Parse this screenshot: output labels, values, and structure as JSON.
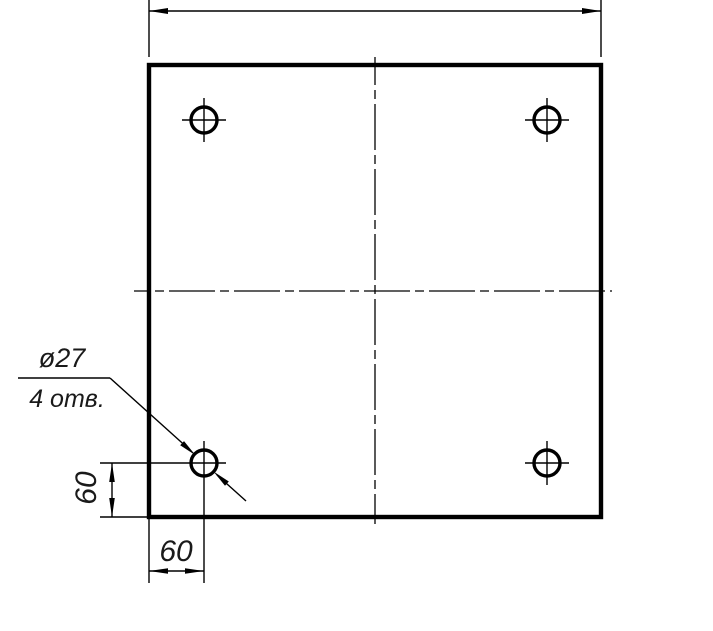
{
  "drawing": {
    "kind": "engineering-drawing",
    "colors": {
      "line": "#000000",
      "background": "#ffffff"
    },
    "callout": {
      "diameter_label": "ø27",
      "count_label": "4 отв."
    },
    "dimensions": {
      "left_vertical": "60",
      "bottom_horizontal": "60",
      "top_overall_label": ""
    },
    "hole_count": 4
  }
}
